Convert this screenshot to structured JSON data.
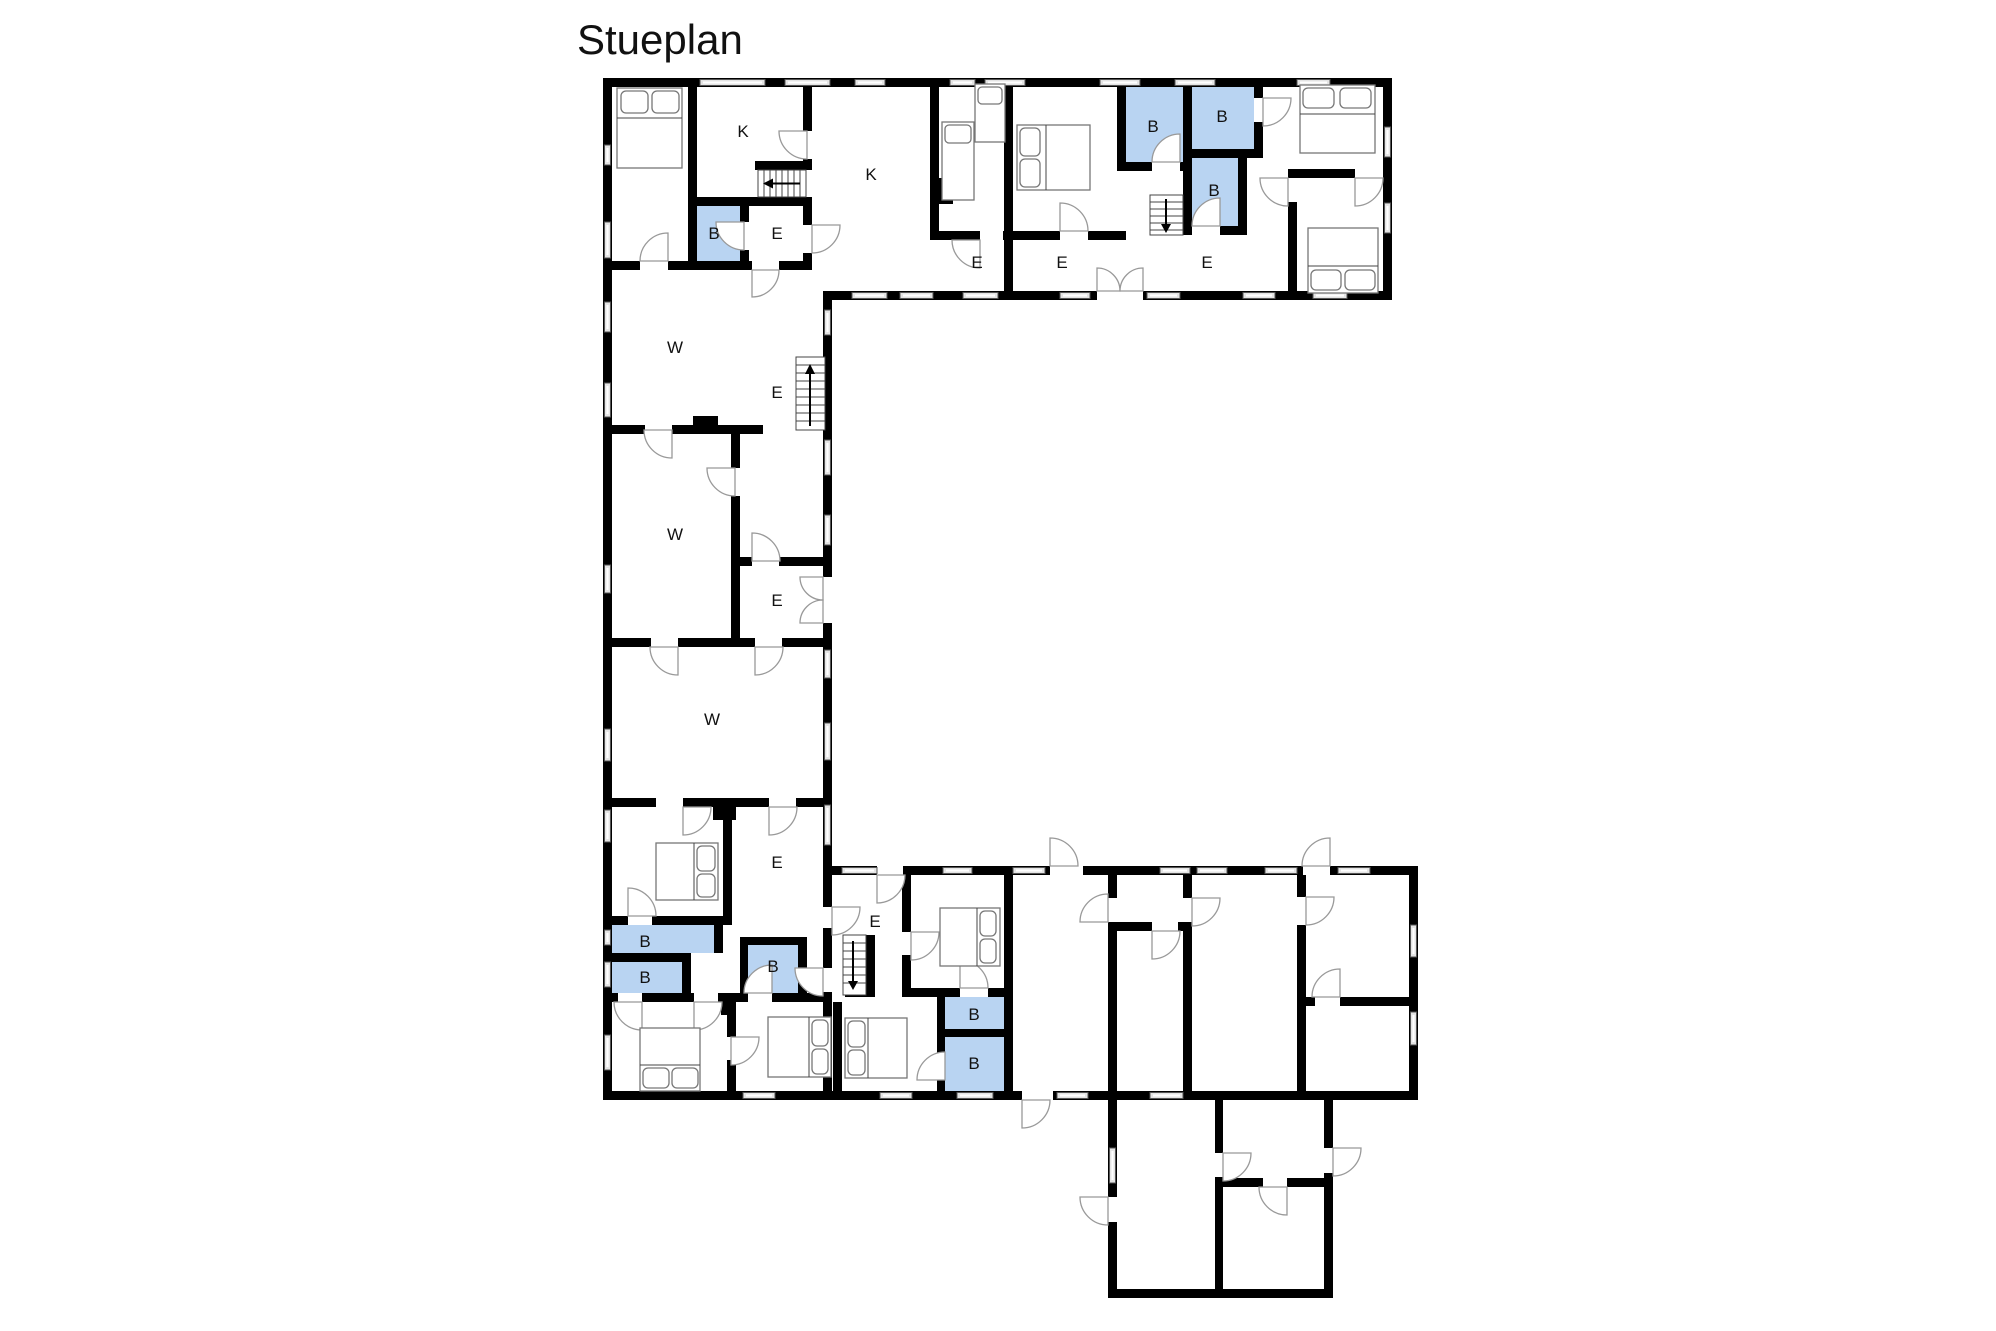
{
  "title": "Stueplan",
  "colors": {
    "bathroom_highlight": "#b9d4f2",
    "wall": "#000000",
    "window": "#e4e4e4",
    "door_arc": "#999999"
  },
  "legend": {
    "room_codes": [
      "K",
      "W",
      "E",
      "B"
    ]
  },
  "rooms": [
    {
      "label": "K",
      "x": 743,
      "y": 131
    },
    {
      "label": "K",
      "x": 871,
      "y": 174
    },
    {
      "label": "B",
      "x": 714,
      "y": 233
    },
    {
      "label": "E",
      "x": 777,
      "y": 233
    },
    {
      "label": "E",
      "x": 977,
      "y": 262
    },
    {
      "label": "E",
      "x": 1062,
      "y": 262
    },
    {
      "label": "E",
      "x": 1207,
      "y": 262
    },
    {
      "label": "B",
      "x": 1153,
      "y": 126
    },
    {
      "label": "B",
      "x": 1222,
      "y": 116
    },
    {
      "label": "B",
      "x": 1214,
      "y": 190
    },
    {
      "label": "W",
      "x": 675,
      "y": 347
    },
    {
      "label": "E",
      "x": 777,
      "y": 392
    },
    {
      "label": "W",
      "x": 675,
      "y": 534
    },
    {
      "label": "E",
      "x": 777,
      "y": 600
    },
    {
      "label": "W",
      "x": 712,
      "y": 719
    },
    {
      "label": "E",
      "x": 777,
      "y": 862
    },
    {
      "label": "E",
      "x": 875,
      "y": 921
    },
    {
      "label": "B",
      "x": 645,
      "y": 941
    },
    {
      "label": "B",
      "x": 645,
      "y": 977
    },
    {
      "label": "B",
      "x": 773,
      "y": 966
    },
    {
      "label": "B",
      "x": 974,
      "y": 1014
    },
    {
      "label": "B",
      "x": 974,
      "y": 1063
    }
  ]
}
